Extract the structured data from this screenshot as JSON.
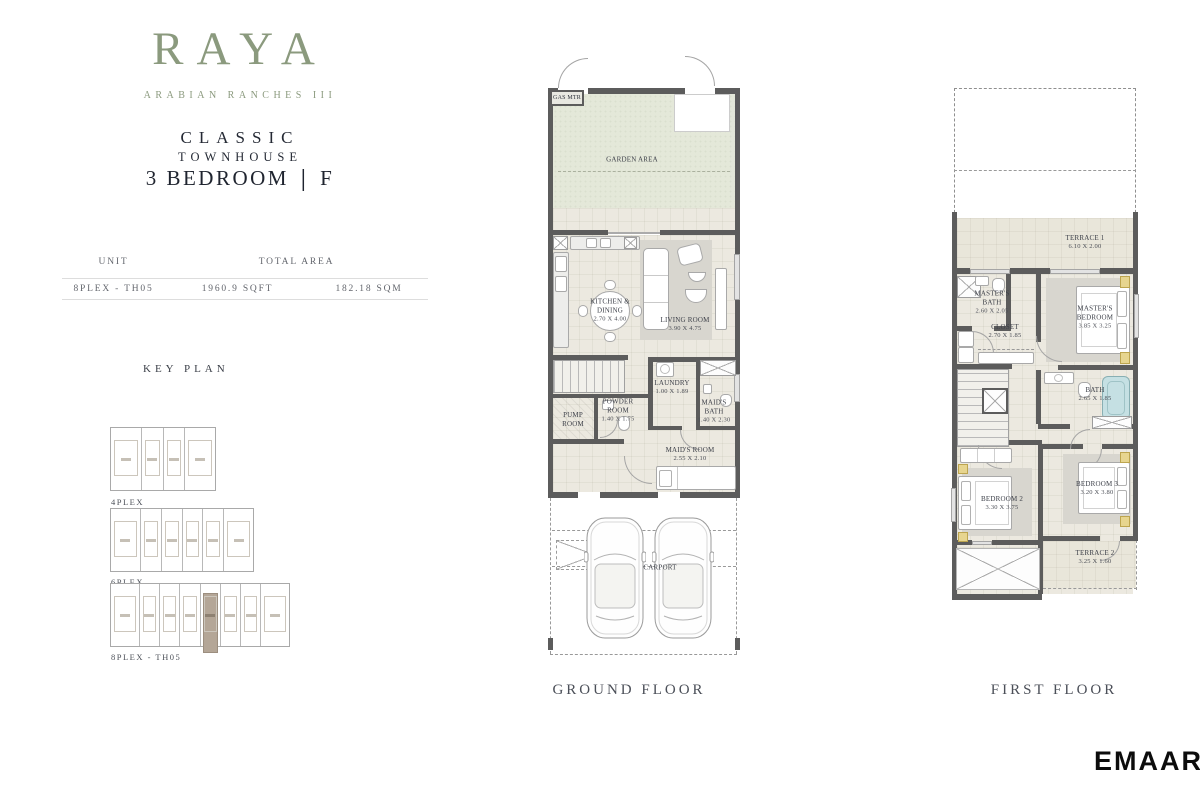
{
  "brand": {
    "logo": "RAYA",
    "subtitle": "ARABIAN RANCHES III",
    "developer": "EMAAR"
  },
  "title": {
    "classic": "CLASSIC",
    "townhouse": "TOWNHOUSE",
    "bedrooms": "3 BEDROOM",
    "separator": "|",
    "type": "F"
  },
  "unit_table": {
    "unit_header": "UNIT",
    "area_header": "TOTAL AREA",
    "unit": "8PLEX - TH05",
    "area_sqft": "1960.9 SQFT",
    "area_sqm": "182.18 SQM"
  },
  "key_plan": {
    "heading": "KEY PLAN",
    "plex4": "4PLEX",
    "plex6": "6PLEX",
    "plex8": "8PLEX - TH05"
  },
  "ground_floor": {
    "caption": "GROUND FLOOR",
    "gas_meter": "GAS MTR",
    "garden": {
      "name": "GARDEN AREA"
    },
    "kitchen": {
      "name": "KITCHEN &",
      "name2": "DINING",
      "dim": "2.70 X 4.00"
    },
    "living": {
      "name": "LIVING ROOM",
      "dim": "3.90 X 4.75"
    },
    "laundry": {
      "name": "LAUNDRY",
      "dim": "1.00 X 1.89"
    },
    "pump": {
      "name": "PUMP",
      "name2": "ROOM"
    },
    "powder": {
      "name": "POWDER",
      "name2": "ROOM",
      "dim": "1.40 X 1.75"
    },
    "maids_bath": {
      "name": "MAID'S",
      "name2": "BATH",
      "dim": "1.40 X 2.30"
    },
    "maids_room": {
      "name": "MAID'S ROOM",
      "dim": "2.55 X 2.10"
    },
    "carport": {
      "name": "CARPORT"
    }
  },
  "first_floor": {
    "caption": "FIRST FLOOR",
    "terrace1": {
      "name": "TERRACE 1",
      "dim": "6.10 X 2.00"
    },
    "masters_bath": {
      "name": "MASTER'S",
      "name2": "BATH",
      "dim": "2.60 X 2.05"
    },
    "closet": {
      "name": "CLOSET",
      "dim": "2.70 X 1.85"
    },
    "masters_bedroom": {
      "name": "MASTER'S",
      "name2": "BEDROOM",
      "dim": "3.85 X 3.25"
    },
    "bath": {
      "name": "BATH",
      "dim": "2.65 X 1.85"
    },
    "bedroom2": {
      "name": "BEDROOM 2",
      "dim": "3.30 X 3.75"
    },
    "bedroom3": {
      "name": "BEDROOM 3",
      "dim": "3.20 X 3.80"
    },
    "terrace2": {
      "name": "TERRACE 2",
      "dim": "3.25 X 1.60"
    }
  },
  "colors": {
    "logo_green": "#8b9a7e",
    "title_dark": "#242934",
    "garden_green": "#e4e8d9",
    "floor_beige": "#ece9e0",
    "wall_gray": "#5c5c5c",
    "rug_gray": "#d8d6cf",
    "keyplan_highlight": "#b4a697",
    "bathtub_blue": "#c5e0e3"
  }
}
